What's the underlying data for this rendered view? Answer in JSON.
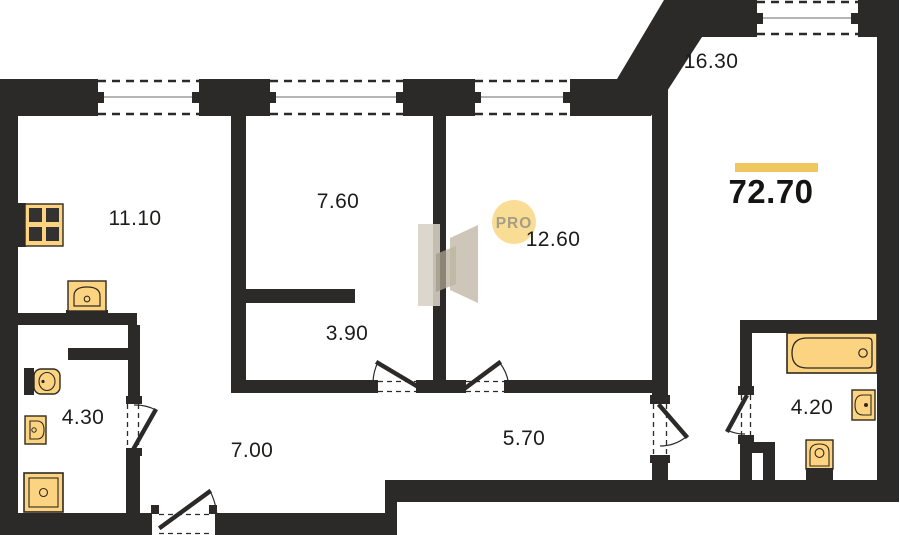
{
  "plan": {
    "total_area": "72.70",
    "badge": "PRO",
    "rooms": [
      {
        "id": "room-11-10",
        "area": "11.10"
      },
      {
        "id": "room-7-60",
        "area": "7.60"
      },
      {
        "id": "room-12-60",
        "area": "12.60"
      },
      {
        "id": "room-16-30",
        "area": "16.30"
      },
      {
        "id": "room-3-90",
        "area": "3.90"
      },
      {
        "id": "room-4-30",
        "area": "4.30"
      },
      {
        "id": "room-7-00",
        "area": "7.00"
      },
      {
        "id": "room-5-70",
        "area": "5.70"
      },
      {
        "id": "room-4-20",
        "area": "4.20"
      }
    ]
  },
  "colors": {
    "wall": "#2b2a29",
    "fixture_fill": "#fcd381",
    "fixture_stroke": "#2e2a20",
    "burner": "#343230",
    "accent_bar": "#f0c75e",
    "badge_bg": "#f9dd94",
    "badge_text": "#a79d86",
    "watermark_light": "#d8d2c6",
    "watermark_mid": "#c7bfb0",
    "watermark_dark": "#b5ab99",
    "window_glass_line": "#6b6b6b"
  }
}
